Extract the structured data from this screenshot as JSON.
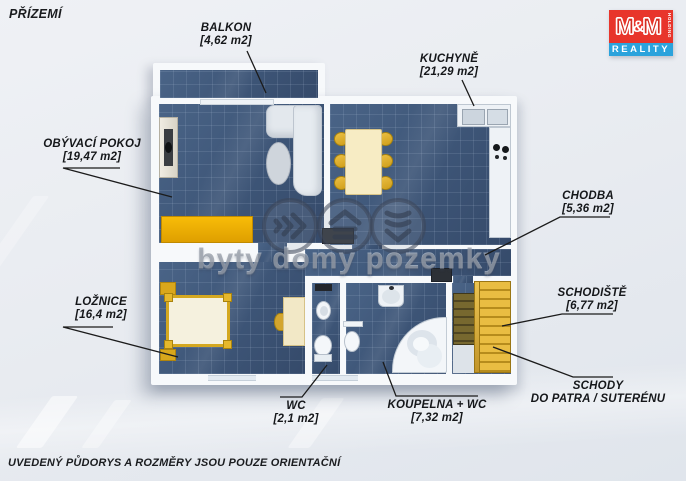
{
  "header": {
    "floor_title": "PŘÍZEMÍ"
  },
  "footer": {
    "disclaimer": "UVEDENÝ PŮDORYS A ROZMĚRY JSOU POUZE ORIENTAČNÍ"
  },
  "logo": {
    "m_left": "M",
    "ampersand": "&",
    "m_right": "M",
    "holding": "HOLDING",
    "reality": "REALITY"
  },
  "watermark": {
    "text": "byty domy pozemky"
  },
  "rooms": {
    "balkon": {
      "name": "BALKON",
      "area": "[4,62 m2]"
    },
    "kuchyne": {
      "name": "KUCHYNĚ",
      "area": "[21,29 m2]"
    },
    "obyvaci_pokoj": {
      "name": "OBÝVACÍ POKOJ",
      "area": "[19,47 m2]"
    },
    "chodba": {
      "name": "CHODBA",
      "area": "[5,36 m2]"
    },
    "schodiste": {
      "name": "SCHODIŠTĚ",
      "area": "[6,77 m2]"
    },
    "loznice": {
      "name": "LOŽNICE",
      "area": "[16,4 m2]"
    },
    "wc": {
      "name": "WC",
      "area": "[2,1 m2]"
    },
    "koupelna_wc": {
      "name": "KOUPELNA + WC",
      "area": "[7,32 m2]"
    },
    "schody": {
      "name": "SCHODY",
      "sub": "DO PATRA / SUTERÉNU"
    }
  },
  "colors": {
    "floor_navy": "#3e5678",
    "furniture_gold": "#d9a520",
    "logo_red": "#e8352b",
    "logo_blue": "#2ba3dc"
  }
}
